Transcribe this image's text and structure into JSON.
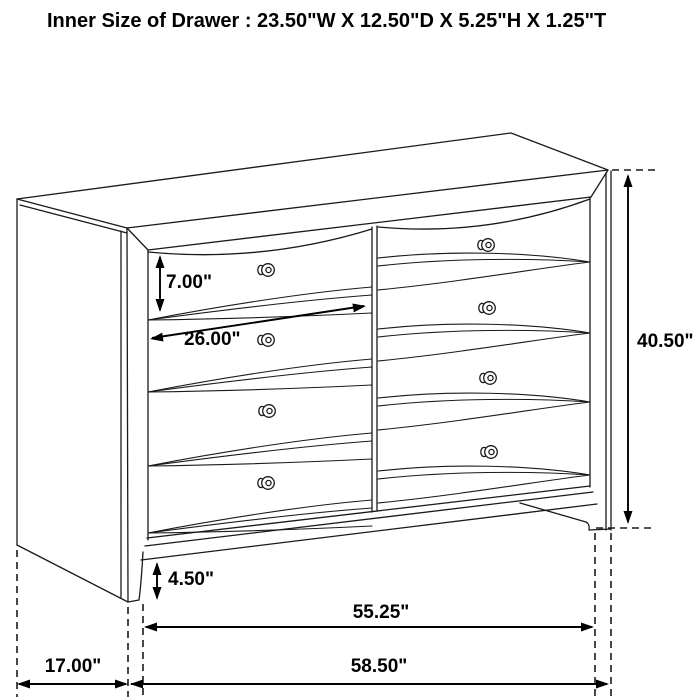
{
  "title": "Inner Size of Drawer : 23.50\"W X 12.50\"D X 5.25\"H X 1.25\"T",
  "dimensions": {
    "drawer_front_height": "7.00\"",
    "drawer_width": "26.00\"",
    "overall_height": "40.50\"",
    "base_height": "4.50\"",
    "inner_width": "55.25\"",
    "depth": "17.00\"",
    "overall_width": "58.50\""
  },
  "colors": {
    "line": "#1a1a1a",
    "background": "#ffffff"
  }
}
